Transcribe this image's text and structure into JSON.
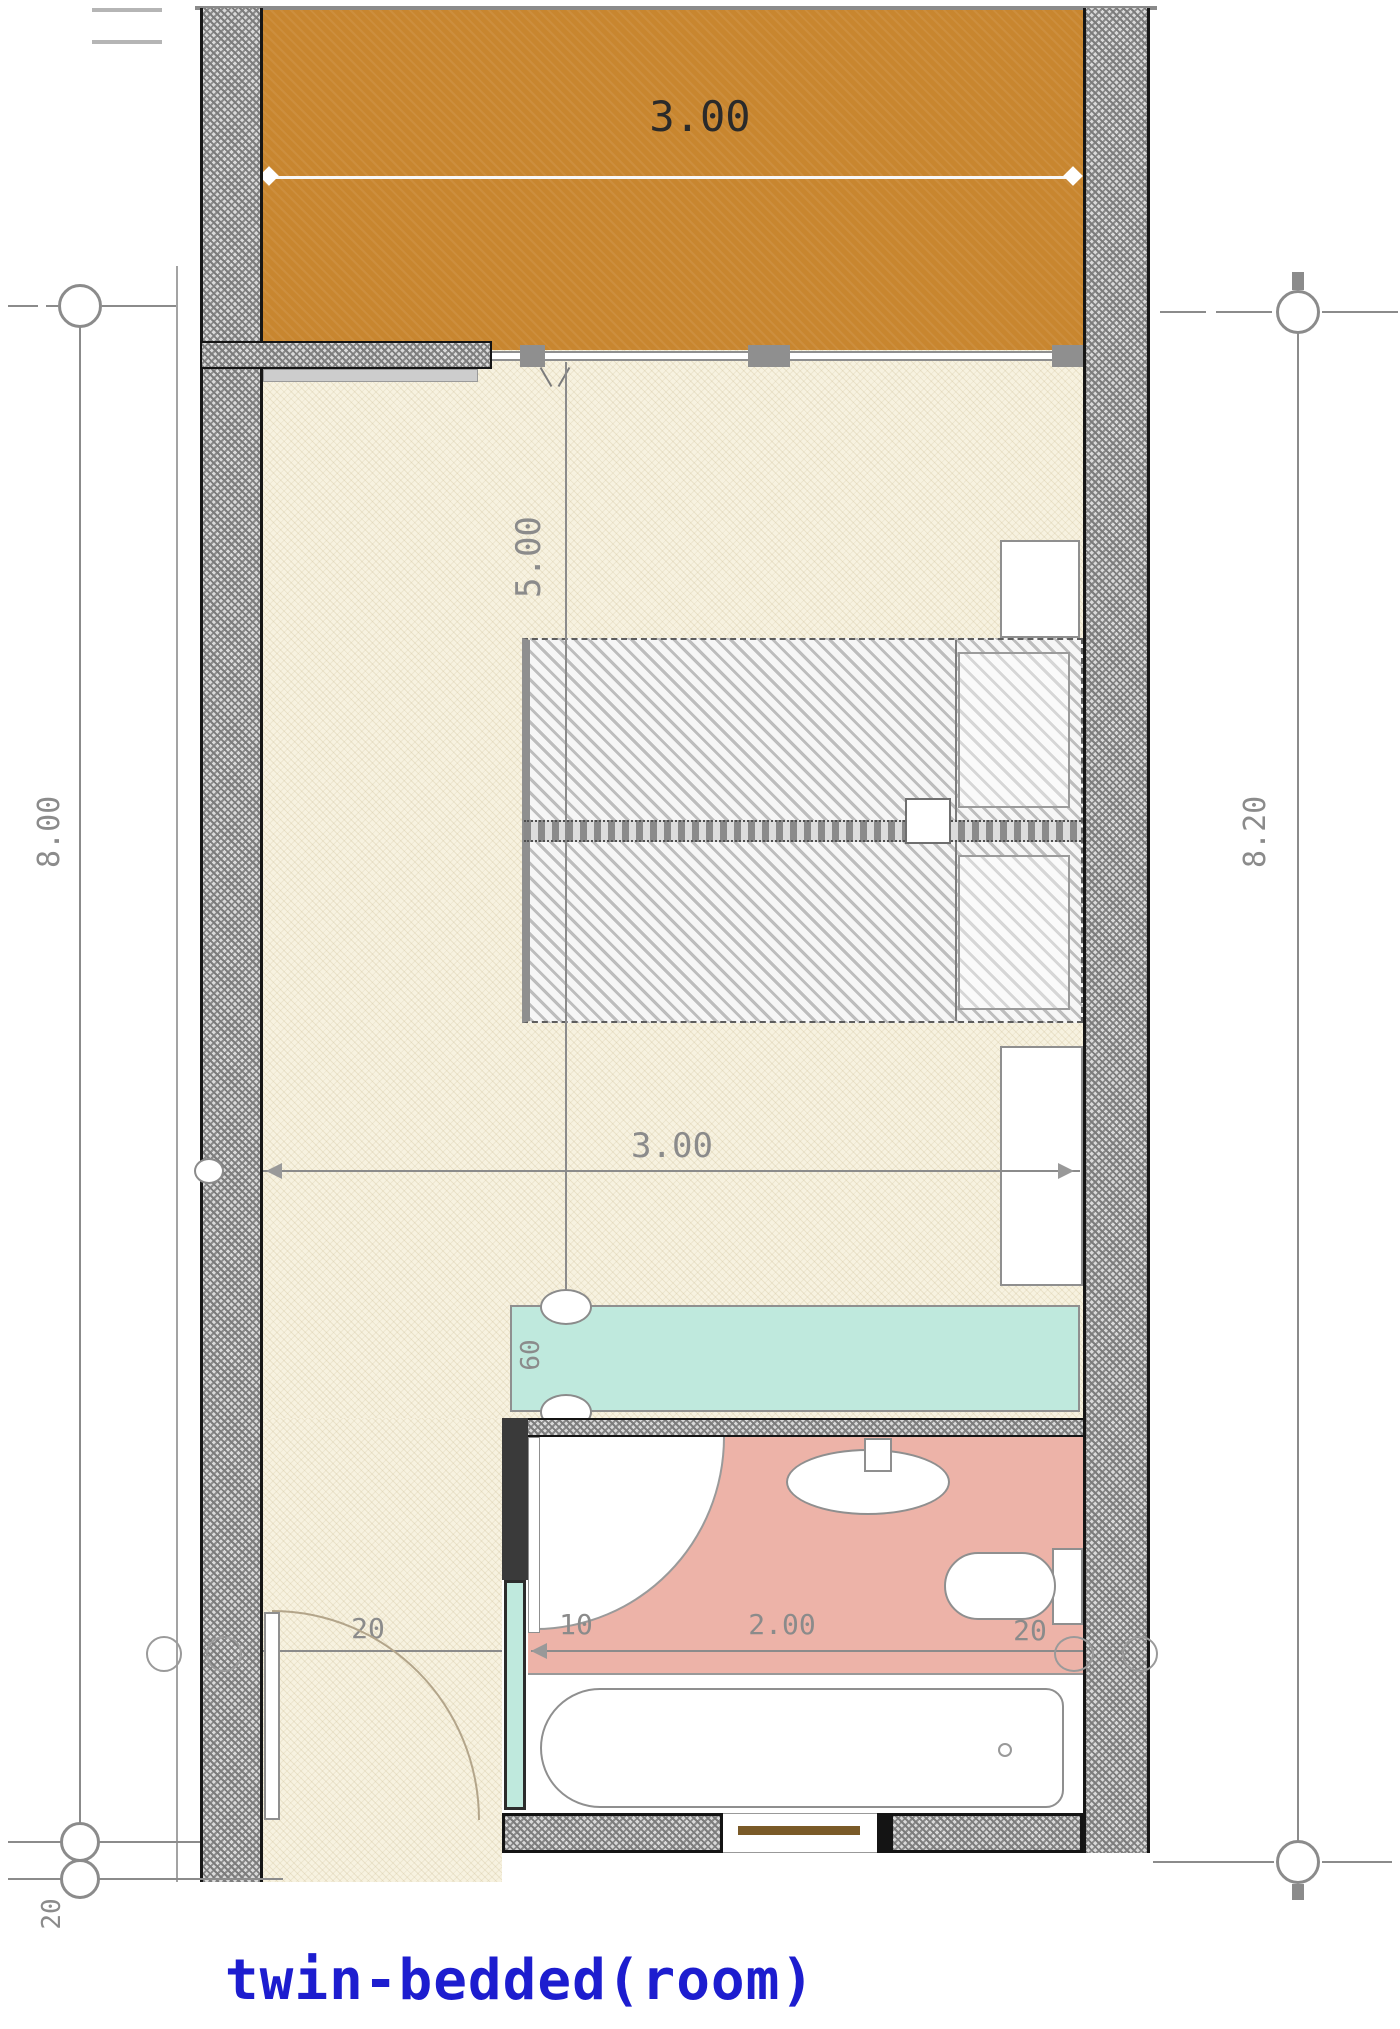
{
  "title": {
    "text": "twin-bedded(room)",
    "color": "#1d1dcf"
  },
  "dims": {
    "balcony_width": "3.00",
    "room_length": "5.00",
    "room_width": "3.00",
    "closet_depth": "60",
    "left_overall": "8.00",
    "right_overall": "8.20",
    "bottom_wall": "20",
    "bath_left": "20",
    "bath_door": "10",
    "bath_width": "2.00",
    "bath_right": "20"
  },
  "colors": {
    "balcony": "#c8862f",
    "bedroom_floor": "#f7f2e0",
    "bathroom": "#edb3a8",
    "closet": "#bfe9dd",
    "wall": "#e3e3e3",
    "dimension": "#8b8b8b",
    "title": "#1d1dcf"
  },
  "fixtures": {
    "bed_1": "twin-bed-1",
    "bed_2": "twin-bed-2",
    "nightstand": "nightstand",
    "dresser": "dresser",
    "wardrobe": "wardrobe-closet",
    "sink": "sink",
    "toilet": "toilet",
    "bathtub": "bathtub",
    "entry_door": "entry-door",
    "bath_door": "bathroom-door"
  }
}
